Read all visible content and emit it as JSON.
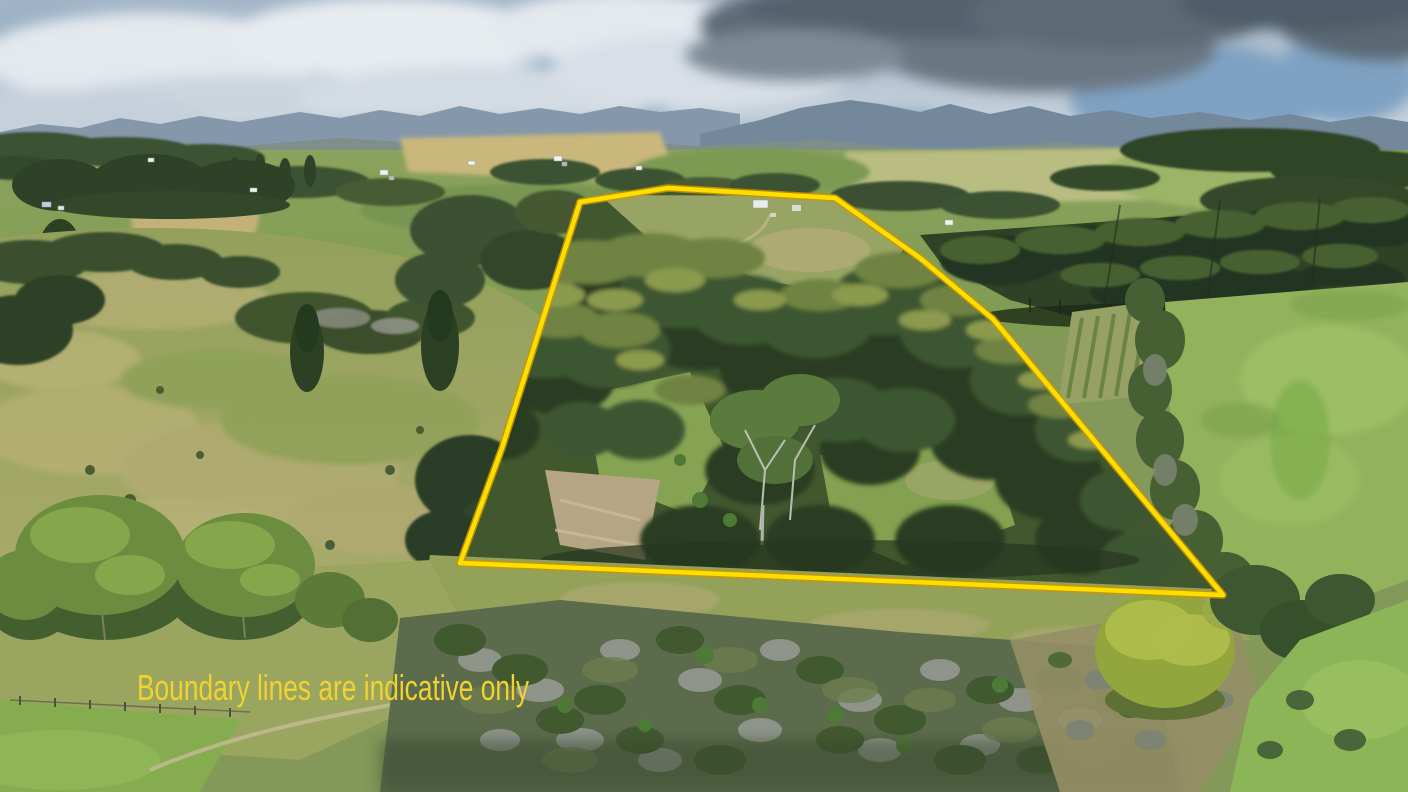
{
  "caption": {
    "text": "Boundary lines are indicative only",
    "color": "#f2d22e"
  },
  "boundary": {
    "points": "580,202 668,188 835,198 920,258 993,319 1223,595 460,563 502,448",
    "color": "#ffdf00",
    "edge_color": "#cf9400"
  }
}
